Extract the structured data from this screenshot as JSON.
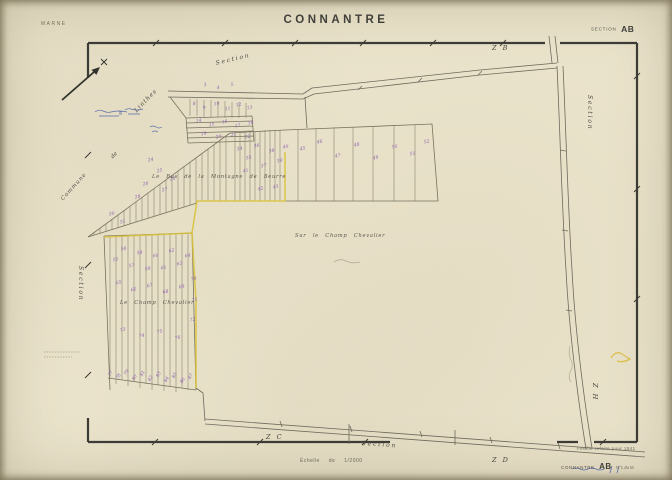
{
  "header": {
    "department": "MARNE",
    "title": "CONNANTRE",
    "section_word": "SECTION",
    "section_code": "AB"
  },
  "map_labels": {
    "section_top": "Section",
    "section_left": "Section",
    "section_right": "Section",
    "section_bottom": "Section",
    "zone_b": "Z B",
    "zone_c": "Z C",
    "zone_d": "Z D",
    "zone_h": "Z H",
    "commune_word": "Commune",
    "de_word": "de",
    "linthes": "Linthes",
    "lieu_montagne": "Le Bas de la Montagne de Beurre",
    "lieu_sur_champ": "Sur le Champ Chevalier",
    "lieu_champ": "Le Champ Chevalier"
  },
  "footer": {
    "scale_label": "Échelle de 1/2000",
    "revision_note": "Feuille refaite pour 1941",
    "sheet_commune": "CONNANTRE",
    "sheet_section": "AB",
    "sheet_detail": "N°1 du M"
  },
  "colors": {
    "paper": "#eae3cb",
    "frame": "#3c3b35",
    "ink": "#6e6a5c",
    "parcel_number": "#8f63b0",
    "boundary_yellow": "#d9c23a",
    "blue_ink": "#4a5fa8"
  },
  "parcel_numbers": [
    {
      "x": 204,
      "y": 84,
      "v": "3"
    },
    {
      "x": 217,
      "y": 87,
      "v": "4"
    },
    {
      "x": 231,
      "y": 84,
      "v": "5"
    },
    {
      "x": 193,
      "y": 103,
      "v": "8"
    },
    {
      "x": 203,
      "y": 107,
      "v": "9"
    },
    {
      "x": 214,
      "y": 103,
      "v": "10"
    },
    {
      "x": 225,
      "y": 108,
      "v": "11"
    },
    {
      "x": 236,
      "y": 104,
      "v": "12"
    },
    {
      "x": 247,
      "y": 107,
      "v": "13"
    },
    {
      "x": 196,
      "y": 120,
      "v": "14"
    },
    {
      "x": 209,
      "y": 124,
      "v": "15"
    },
    {
      "x": 222,
      "y": 121,
      "v": "16"
    },
    {
      "x": 235,
      "y": 125,
      "v": "17"
    },
    {
      "x": 248,
      "y": 122,
      "v": "18"
    },
    {
      "x": 201,
      "y": 133,
      "v": "19"
    },
    {
      "x": 216,
      "y": 136,
      "v": "20"
    },
    {
      "x": 231,
      "y": 134,
      "v": "21"
    },
    {
      "x": 245,
      "y": 136,
      "v": "22"
    },
    {
      "x": 148,
      "y": 159,
      "v": "24"
    },
    {
      "x": 157,
      "y": 170,
      "v": "25"
    },
    {
      "x": 143,
      "y": 183,
      "v": "26"
    },
    {
      "x": 162,
      "y": 189,
      "v": "27"
    },
    {
      "x": 135,
      "y": 196,
      "v": "28"
    },
    {
      "x": 170,
      "y": 178,
      "v": "29"
    },
    {
      "x": 109,
      "y": 213,
      "v": "30"
    },
    {
      "x": 120,
      "y": 221,
      "v": "31"
    },
    {
      "x": 237,
      "y": 148,
      "v": "34"
    },
    {
      "x": 246,
      "y": 157,
      "v": "35"
    },
    {
      "x": 254,
      "y": 145,
      "v": "36"
    },
    {
      "x": 261,
      "y": 165,
      "v": "37"
    },
    {
      "x": 269,
      "y": 150,
      "v": "38"
    },
    {
      "x": 277,
      "y": 160,
      "v": "39"
    },
    {
      "x": 283,
      "y": 146,
      "v": "40"
    },
    {
      "x": 243,
      "y": 170,
      "v": "41"
    },
    {
      "x": 258,
      "y": 188,
      "v": "42"
    },
    {
      "x": 273,
      "y": 186,
      "v": "43"
    },
    {
      "x": 300,
      "y": 148,
      "v": "45"
    },
    {
      "x": 317,
      "y": 141,
      "v": "46"
    },
    {
      "x": 335,
      "y": 155,
      "v": "47"
    },
    {
      "x": 354,
      "y": 144,
      "v": "48"
    },
    {
      "x": 373,
      "y": 157,
      "v": "49"
    },
    {
      "x": 392,
      "y": 146,
      "v": "50"
    },
    {
      "x": 410,
      "y": 153,
      "v": "51"
    },
    {
      "x": 424,
      "y": 141,
      "v": "52"
    },
    {
      "x": 113,
      "y": 259,
      "v": "55"
    },
    {
      "x": 121,
      "y": 248,
      "v": "56"
    },
    {
      "x": 129,
      "y": 265,
      "v": "57"
    },
    {
      "x": 137,
      "y": 252,
      "v": "58"
    },
    {
      "x": 145,
      "y": 268,
      "v": "59"
    },
    {
      "x": 153,
      "y": 255,
      "v": "60"
    },
    {
      "x": 161,
      "y": 267,
      "v": "61"
    },
    {
      "x": 169,
      "y": 250,
      "v": "62"
    },
    {
      "x": 177,
      "y": 263,
      "v": "63"
    },
    {
      "x": 185,
      "y": 255,
      "v": "64"
    },
    {
      "x": 116,
      "y": 282,
      "v": "65"
    },
    {
      "x": 131,
      "y": 289,
      "v": "66"
    },
    {
      "x": 147,
      "y": 285,
      "v": "67"
    },
    {
      "x": 163,
      "y": 291,
      "v": "68"
    },
    {
      "x": 179,
      "y": 286,
      "v": "69"
    },
    {
      "x": 191,
      "y": 278,
      "v": "70"
    },
    {
      "x": 192,
      "y": 299,
      "v": "71"
    },
    {
      "x": 190,
      "y": 319,
      "v": "72"
    },
    {
      "x": 120,
      "y": 329,
      "v": "73"
    },
    {
      "x": 139,
      "y": 335,
      "v": "74"
    },
    {
      "x": 157,
      "y": 331,
      "v": "75"
    },
    {
      "x": 175,
      "y": 337,
      "v": "76"
    },
    {
      "x": 109,
      "y": 372,
      "v": "77",
      "r": -60
    },
    {
      "x": 117,
      "y": 375,
      "v": "78",
      "r": -60
    },
    {
      "x": 125,
      "y": 371,
      "v": "79",
      "r": -60
    },
    {
      "x": 133,
      "y": 376,
      "v": "80",
      "r": -60
    },
    {
      "x": 141,
      "y": 372,
      "v": "81",
      "r": -60
    },
    {
      "x": 149,
      "y": 377,
      "v": "82",
      "r": -60
    },
    {
      "x": 157,
      "y": 373,
      "v": "83",
      "r": -60
    },
    {
      "x": 165,
      "y": 378,
      "v": "84",
      "r": -60
    },
    {
      "x": 173,
      "y": 374,
      "v": "85",
      "r": -60
    },
    {
      "x": 181,
      "y": 379,
      "v": "86",
      "r": -60
    },
    {
      "x": 189,
      "y": 375,
      "v": "87",
      "r": -60
    }
  ]
}
